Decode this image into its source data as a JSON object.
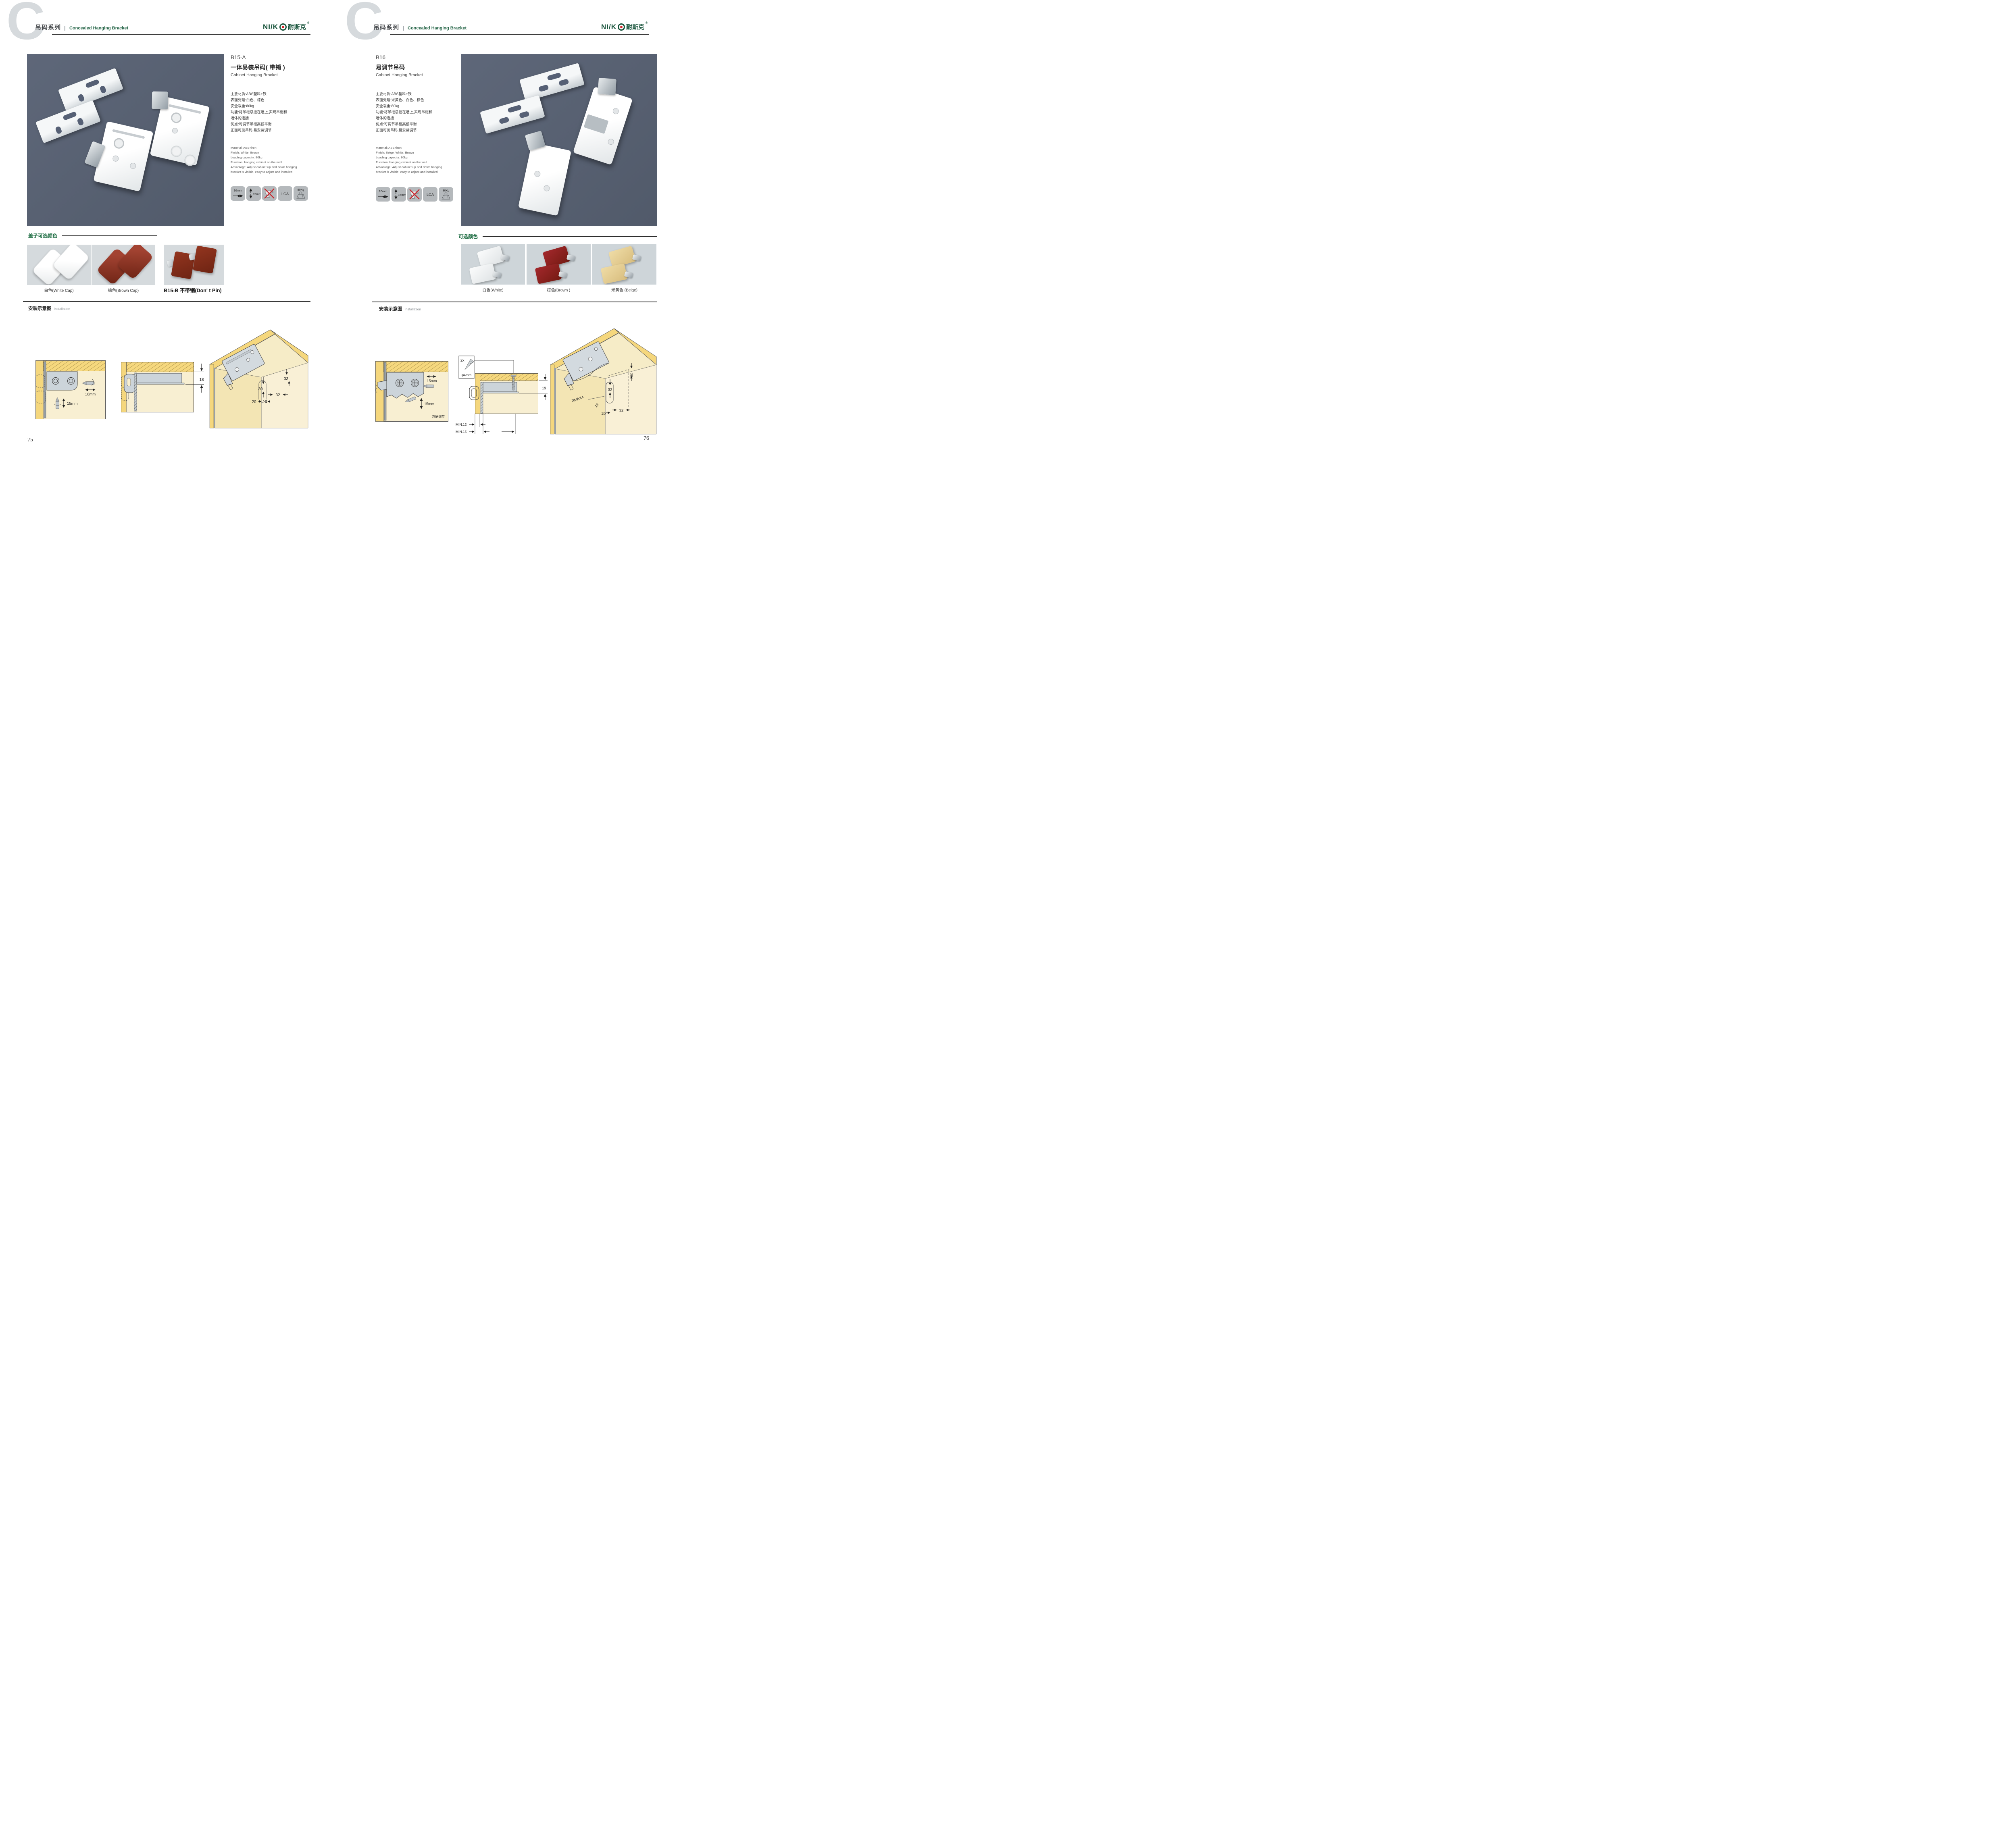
{
  "brand": {
    "logo_latin": "NI/K",
    "logo_cn": "耐斯克",
    "registered": "®"
  },
  "pages": [
    {
      "page_number": "75",
      "header": {
        "watermark": "C",
        "series": "吊码系列",
        "subtitle": "Concealed Hanging Bracket"
      },
      "product": {
        "code": "B15-A",
        "name_cn": "一体易装吊码( 带销 )",
        "name_en": "Cabinet Hanging Bracket",
        "specs_cn": [
          "主要材质:ABS塑料+铁",
          "表面处理:白色、棕色",
          "安全载重:80kg",
          "功能:将吊柜悬挂在墙上,实现吊柜和",
          "墙体的连接",
          "优点:可调节吊柜高低平衡",
          "正面可见吊码,易安装调节"
        ],
        "specs_en": [
          "Material: ABS+iron",
          "Finish: White, Brown",
          "Loading capacity: 80kg",
          "Function: hanging cabinet on the wall",
          "Advantage: Adjust cabinet up and down hanging",
          "bracket is visible, easy to adjust and installed"
        ],
        "icons": {
          "width": "16mm",
          "height": "15mm",
          "cert": "LGA",
          "load": "80Kg"
        }
      },
      "colors": {
        "title": "盖子可选颜色",
        "labels": [
          "白色(White Cap)",
          "棕色(Brown Cap)",
          "B15-B 不带销(Don' t Pin)"
        ]
      },
      "install": {
        "title_cn": "安装示意图",
        "title_en": "Installation",
        "d1": {
          "dim_w": "16mm",
          "dim_h": "15mm"
        },
        "d2": {
          "dim": "18"
        },
        "d3": {
          "dims": [
            "33",
            "30",
            "32",
            "20",
            "14"
          ]
        }
      }
    },
    {
      "page_number": "76",
      "header": {
        "watermark": "C",
        "series": "吊码系列",
        "subtitle": "Concealed Hanging Bracket"
      },
      "product": {
        "code": "B16",
        "name_cn": "易调节吊码",
        "name_en": "Cabinet Hanging Bracket",
        "specs_cn": [
          "主要材质:ABS塑料+铁",
          "表面处理:米黄色、白色、棕色",
          "安全载重:80kg",
          "功能:将吊柜悬挂在墙上,实现吊柜和",
          "墙体的连接",
          "优点:可调节吊柜高低平衡",
          "正面可见吊码,易安装调节"
        ],
        "specs_en": [
          "Material: ABS+iron",
          "Finish: Beige, White, Brown",
          "Loading capacity: 80kg",
          "Function: hanging cabinet on the wall",
          "Advantage: Adjust cabinet up and down hanging",
          "bracket is visible, easy to adjust and installed"
        ],
        "icons": {
          "width": "10mm",
          "height": "15mm",
          "cert": "LGA",
          "load": "80Kg"
        }
      },
      "colors": {
        "title": "可选颜色",
        "labels": [
          "白色(White)",
          "棕色(Brown )",
          "米黄色 (Beige)"
        ]
      },
      "install": {
        "title_cn": "安装示意图",
        "title_en": "Installation",
        "d1": {
          "dim_w": "15mm",
          "dim_h": "15mm",
          "note": "方便调节"
        },
        "screw_box": {
          "qty": "2x",
          "size": "φ4mm"
        },
        "d2": {
          "dim": "19",
          "min1": "MIN.12",
          "min2": "MIN.15"
        },
        "d3": {
          "dims": [
            "30",
            "32",
            "RMAX4",
            "19",
            "20",
            "32"
          ]
        }
      }
    }
  ]
}
